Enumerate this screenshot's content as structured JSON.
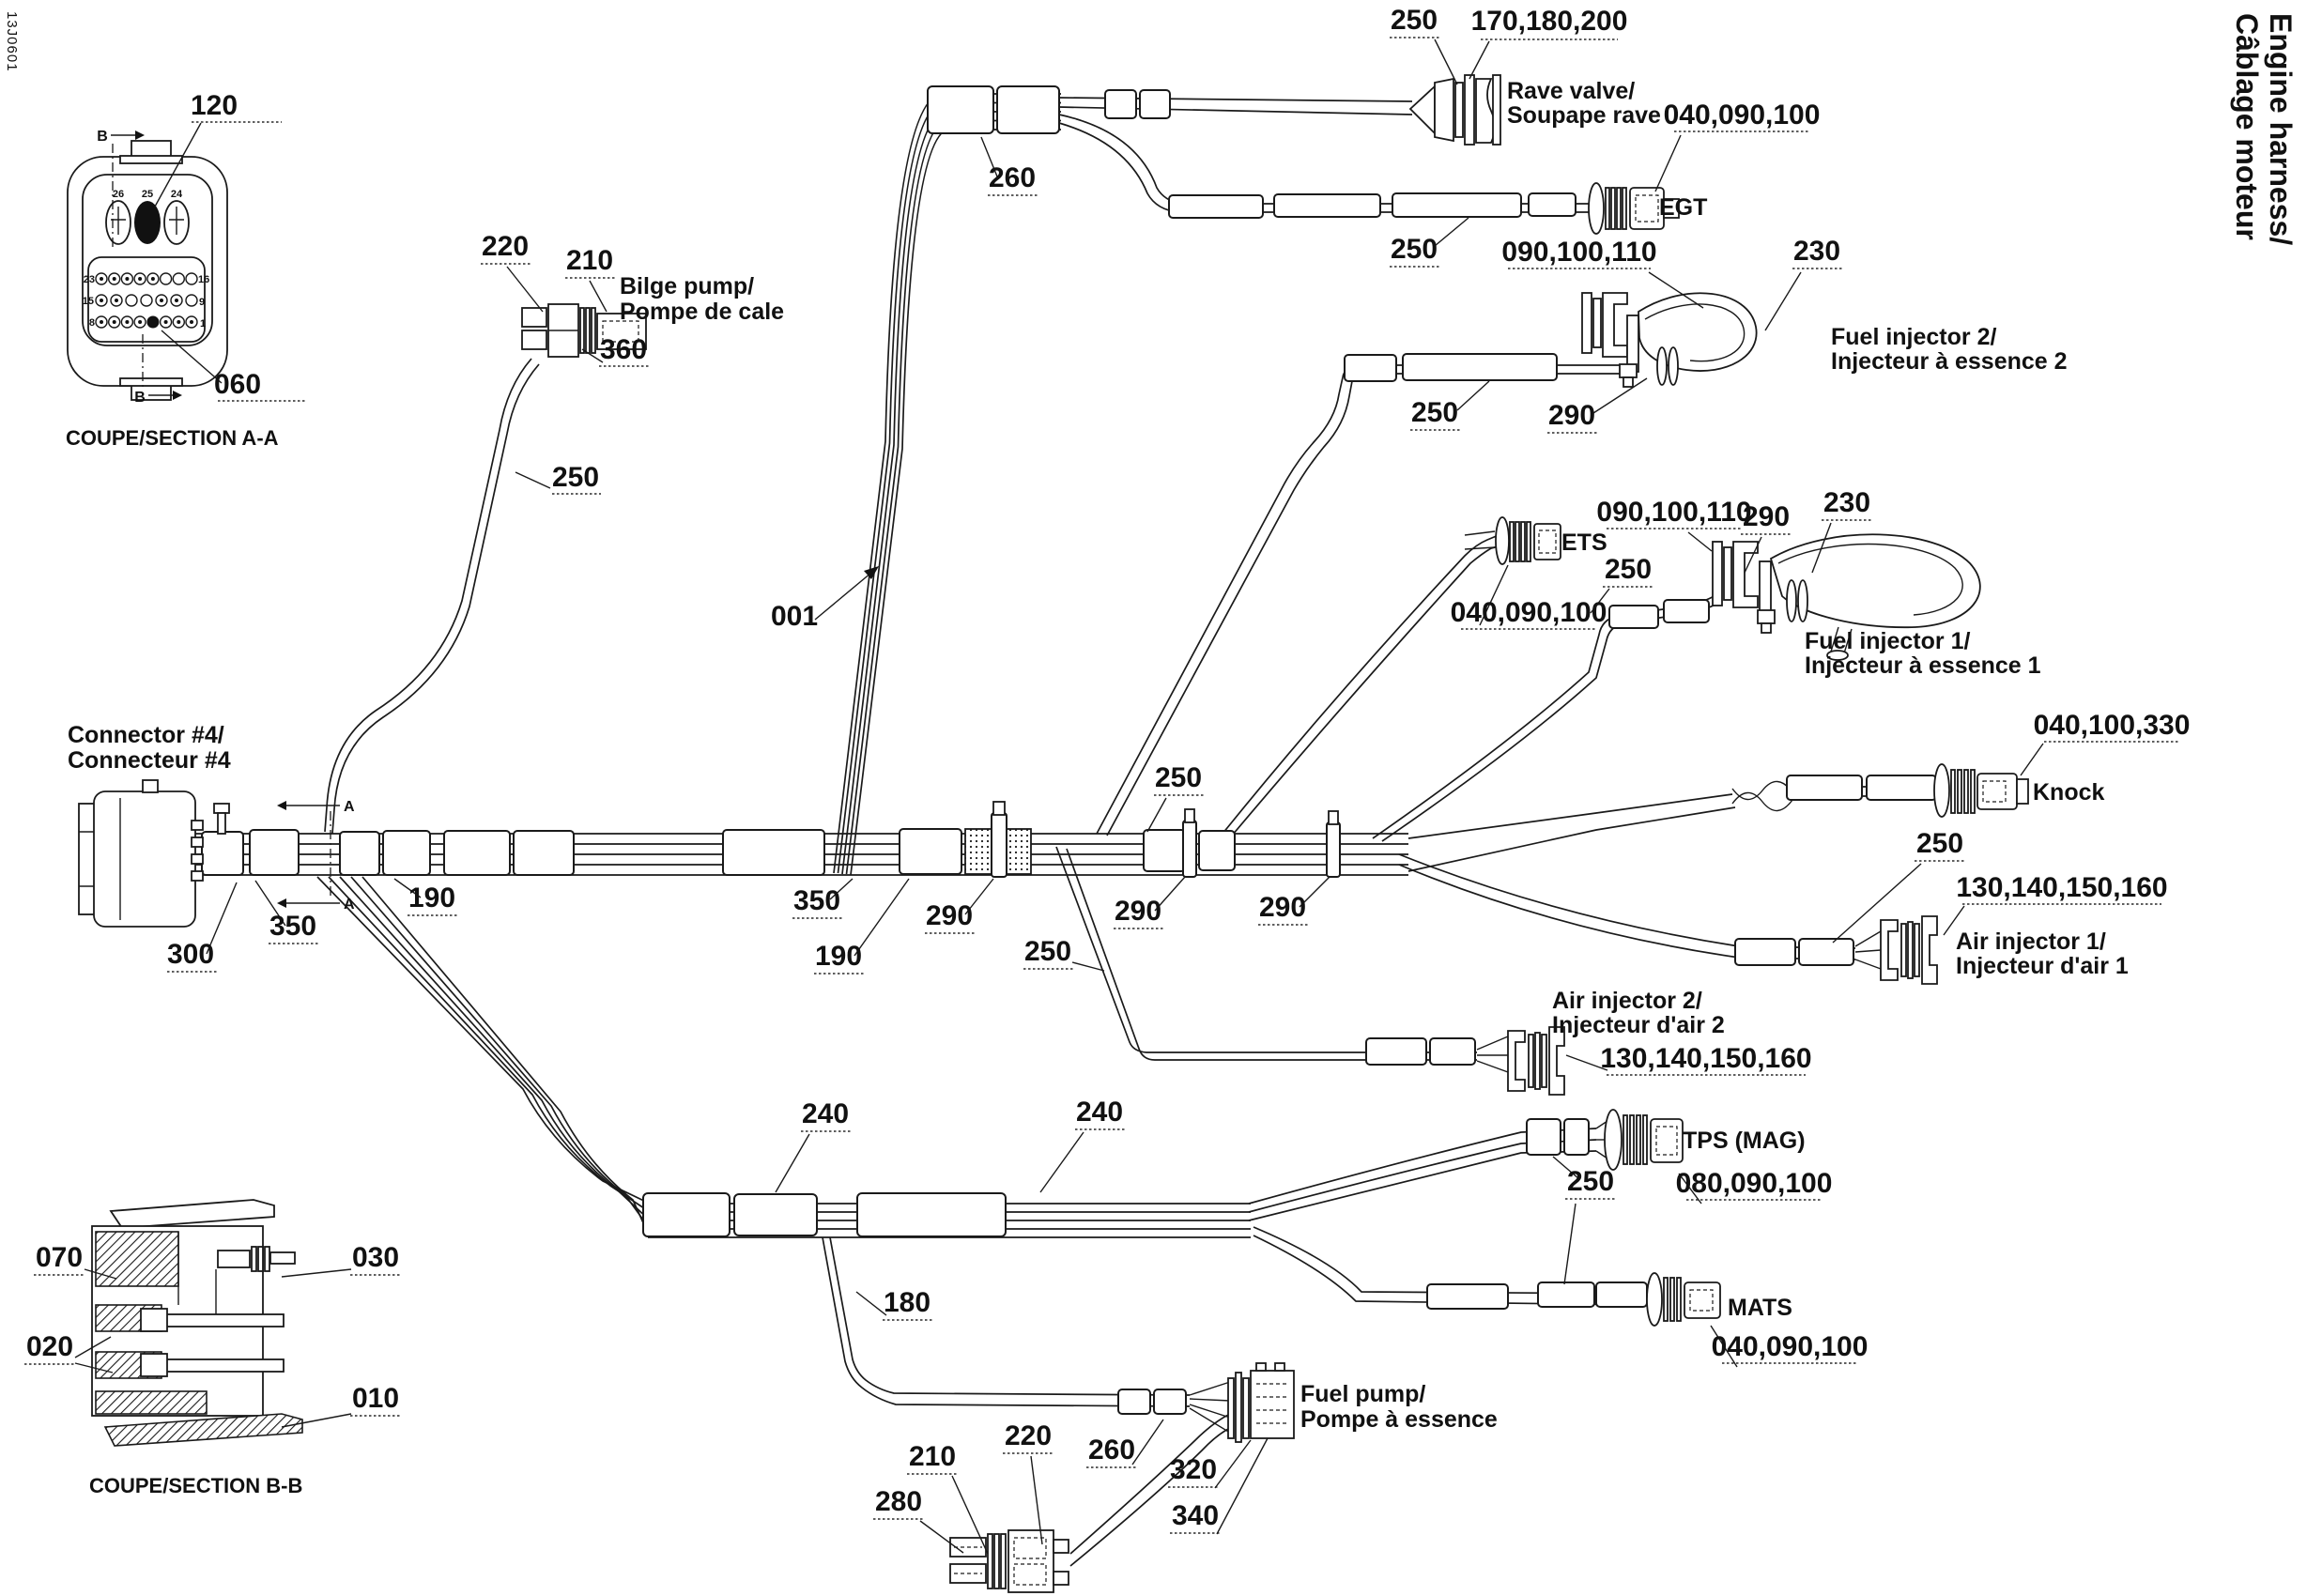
{
  "doc_number": "13J0601",
  "title": {
    "line1": "Engine harness/",
    "line2": "Câblage moteur"
  },
  "section_aa": {
    "caption": "COUPE/SECTION A-A",
    "pins": {
      "n26": "26",
      "n25": "25",
      "n24": "24",
      "n23": "23",
      "n16": "16",
      "n15": "15",
      "n9": "9",
      "n8": "8",
      "n1": "1"
    }
  },
  "section_bb": {
    "caption": "COUPE/SECTION B-B"
  },
  "letters": {
    "a": "A",
    "b": "B"
  },
  "parts": {
    "p001": "001",
    "p010": "010",
    "p020": "020",
    "p030": "030",
    "p060": "060",
    "p070": "070",
    "p120": "120",
    "p180": "180",
    "p190": "190",
    "p210": "210",
    "p220": "220",
    "p230": "230",
    "p240": "240",
    "p250": "250",
    "p260": "260",
    "p280": "280",
    "p290": "290",
    "p300": "300",
    "p320": "320",
    "p340": "340",
    "p350": "350",
    "p360": "360",
    "p040_090_100": "040,090,100",
    "p040_100_330": "040,100,330",
    "p080_090_100": "080,090,100",
    "p090_100_110": "090,100,110",
    "p130_140_150_160": "130,140,150,160",
    "p170_180_200": "170,180,200"
  },
  "components": {
    "connector4": {
      "line1": "Connector #4/",
      "line2": "Connecteur #4"
    },
    "bilge_pump": {
      "line1": "Bilge pump/",
      "line2": "Pompe de cale"
    },
    "rave_valve": {
      "line1": "Rave valve/",
      "line2": "Soupape rave"
    },
    "egt": "EGT",
    "ets": "ETS",
    "knock": "Knock",
    "tps": "TPS (MAG)",
    "mats": "MATS",
    "fuel_pump": {
      "line1": "Fuel pump/",
      "line2": "Pompe à essence"
    },
    "fuel_injector1": {
      "line1": "Fuel injector 1/",
      "line2": "Injecteur à essence 1"
    },
    "fuel_injector2": {
      "line1": "Fuel injector 2/",
      "line2": "Injecteur à essence 2"
    },
    "air_injector1": {
      "line1": "Air injector 1/",
      "line2": "Injecteur d'air 1"
    },
    "air_injector2": {
      "line1": "Air injector 2/",
      "line2": "Injecteur d'air 2"
    }
  },
  "colors": {
    "ink": "#1a1a1a",
    "background": "#ffffff"
  }
}
